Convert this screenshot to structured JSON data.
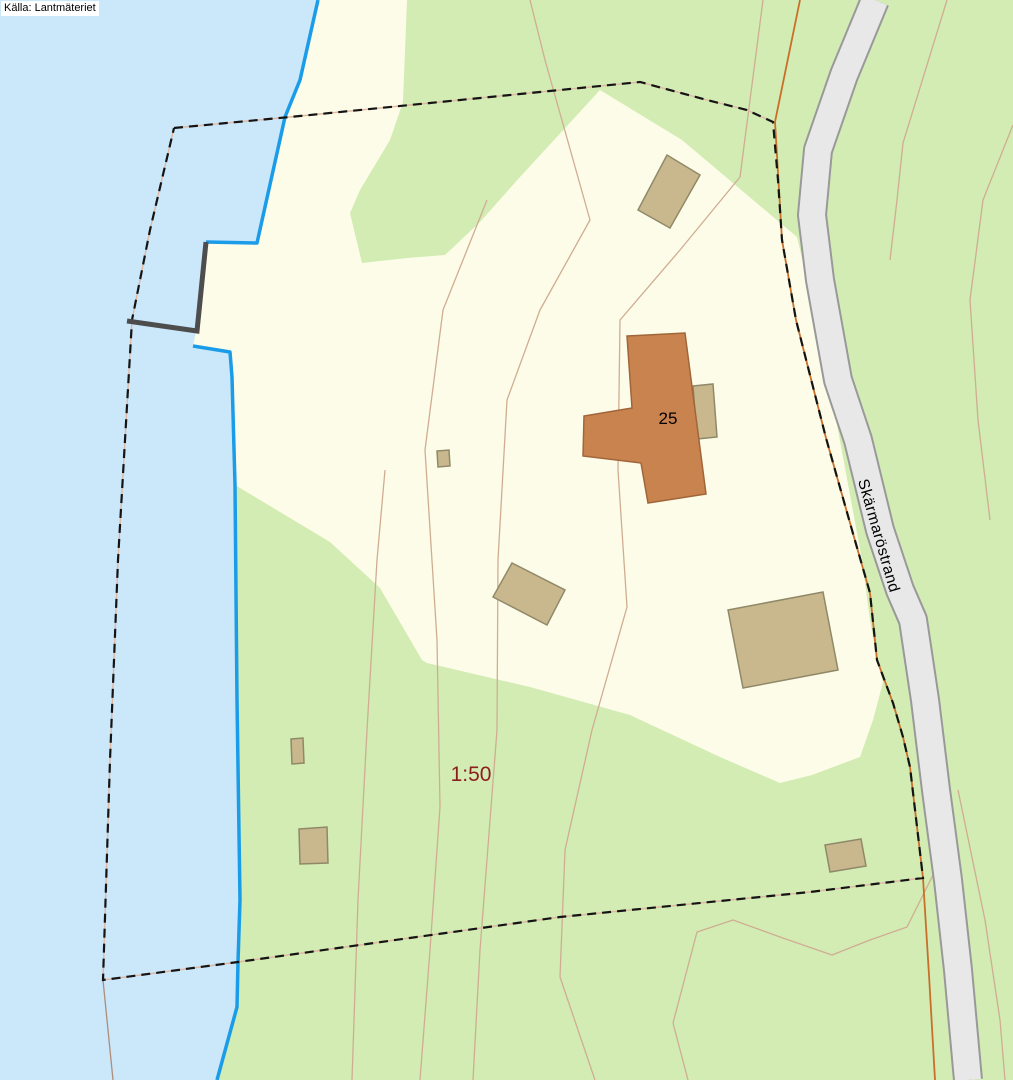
{
  "map": {
    "source_attribution": "Källa: Lantmäteriet",
    "labels": {
      "road": "Skärmaröstrand",
      "parcel": "1:50",
      "building_number": "25"
    },
    "colors": {
      "water": "#cbe7fa",
      "shoreline": "#1b9ce8",
      "open_land": "#fdfce8",
      "forest": "#d2ecb4",
      "road_fill": "#e8e8e8",
      "road_casing": "#999999",
      "contour": "#d0ad92",
      "boundary_dash": "#141414",
      "boundary_underlay": "#e0b8a2",
      "orange_line": "#c96f2a",
      "building_fill": "#c9b88e",
      "building_outline": "#8f8968",
      "main_building_fill": "#c9834f",
      "main_building_outline": "#a0653a",
      "dock": "#4d4d4d",
      "parcel_label_color": "#8e1d1d",
      "label_color": "#000000"
    }
  }
}
